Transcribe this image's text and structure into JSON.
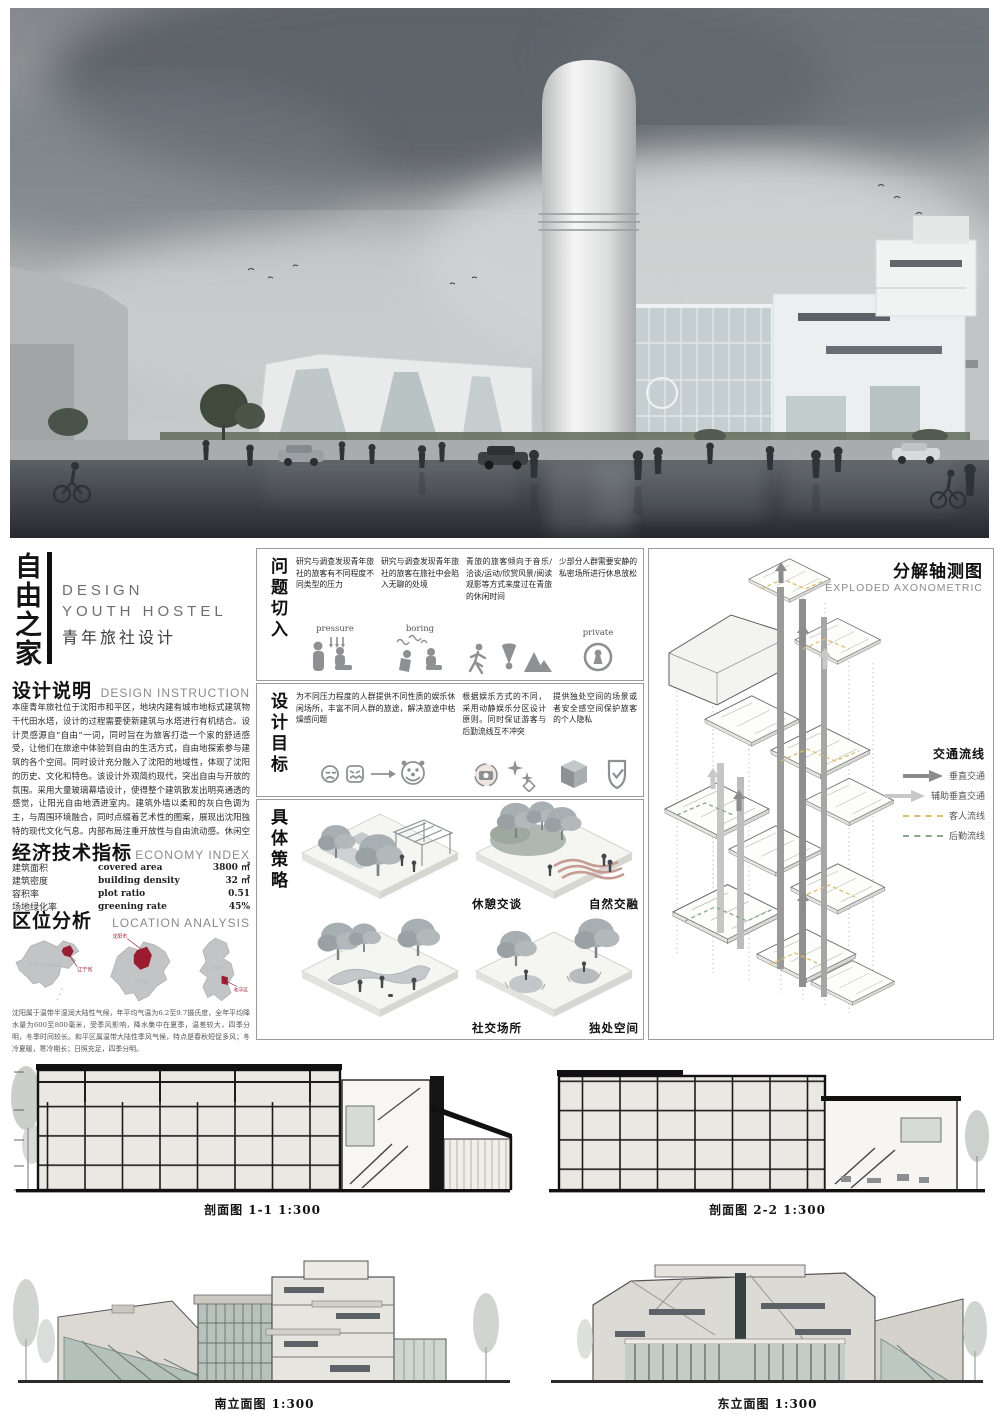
{
  "title_block": {
    "main_title": "自由之家",
    "line_en1": "DESIGN",
    "line_en2": "YOUTH HOSTEL",
    "line_cn": "青年旅社设计"
  },
  "design_instruction": {
    "heading_cn": "设计说明",
    "heading_en": "DESIGN INSTRUCTION",
    "body": "本座青年旅社位于沈阳市和平区，地块内建有城市地标式建筑物千代田水塔，设计的过程需要使新建筑与水塔进行有机结合。设计灵感源自“自由”一词，同时旨在为旅客打造一个家的舒适感受，让他们在旅途中体验到自由的生活方式，自由地探索参与建筑的各个空间。同时设计充分融入了沈阳的地域性，体现了沈阳的历史、文化和特色。该设计外观简约现代，突出自由与开放的氛围。采用大量玻璃幕墙设计，使得整个建筑散发出明亮通透的感觉，让阳光自由地洒进室内。建筑外墙以柔和的灰白色调为主，与周围环境融合，同时点缀着艺术性的图案，展现出沈阳独特的现代文化气息。内部布局注重开放性与自由流动感。休闲空间采用开阔的设计，营造出自由自在的氛围。建筑根据功能自然分为餐饮后勤、休闲娱乐、住宿三大部分，并通过打破各层空间关系、视线和空间保持联通等手法在建筑中体现“自由”的主题。自家青年旅社致力于打造一个温馨舒适、自由自在的旅居空间，让每一位旅客都能在这里找到家的感觉。"
  },
  "economy_index": {
    "heading_cn": "经济技术指标",
    "heading_en": "ECONOMY INDEX",
    "rows": [
      {
        "label_cn": "建筑面积",
        "label_en": "covered area",
        "value": "3800 ㎡"
      },
      {
        "label_cn": "建筑密度",
        "label_en": "building density",
        "value": "32 ㎡"
      },
      {
        "label_cn": "容积率",
        "label_en": "plot ratio",
        "value": "0.51"
      },
      {
        "label_cn": "场地绿化率",
        "label_en": "greening rate",
        "value": "45%"
      }
    ]
  },
  "location_analysis": {
    "heading_cn": "区位分析",
    "heading_en": "LOCATION ANALYSIS",
    "maps": [
      {
        "name": "china-map",
        "highlight_label": "辽宁省",
        "faint_label": "中华人民共和国"
      },
      {
        "name": "liaoning-map",
        "highlight_label": "沈阳市",
        "faint_label": "辽宁省"
      },
      {
        "name": "shenyang-map",
        "highlight_label": "和平区",
        "faint_label": "沈阳市"
      }
    ],
    "note": "沈阳属于温带半湿润大陆性气候，年平均气温为6.2至9.7摄氏度，全年平均降水量为600至800毫米，受季风影响，降水集中在夏季，温差较大，四季分明，冬季时间较长。和平区属温带大陆性季风气候，特点是春秋短促多风；冬冷夏暖，寒冷期长；日照充足，四季分明。"
  },
  "problems": {
    "title": "问题切入",
    "items": [
      {
        "text": "研究与调查发现青年旅社的旅客有不同程度不同类型的压力",
        "icon_word": "pressure",
        "icon": "pressure-massage-icon"
      },
      {
        "text": "研究与调查发现青年旅社的旅客在旅社中会陷入无聊的处境",
        "icon_word": "boring",
        "icon": "boring-sitting-icon"
      },
      {
        "text": "青旅的旅客倾向于音乐/洽谈/运动/欣赏风景/阅读观影等方式来度过在青旅的休闲时间",
        "icon_word": "",
        "icon": "running-badminton-mountain-icons"
      },
      {
        "text": "少部分人群需要安静的私密场所进行休息放松",
        "icon_word": "private",
        "icon": "keyhole-icon"
      }
    ]
  },
  "goals": {
    "title": "设计目标",
    "items": [
      {
        "text": "为不同压力程度的人群提供不同性质的娱乐休闲场所，丰富不同人群的旅途，解决旅途中枯燥感问题",
        "icon": "sad-to-happy-faces-icon"
      },
      {
        "text": "根据娱乐方式的不同，采用动静娱乐分区设计原则。同时保证游客与后勤流线互不冲突",
        "icon": "camera-sparkle-icon"
      },
      {
        "text": "提供独处空间的场景或者安全感空间保护旅客的个人隐私",
        "icon": "cube-shield-icon"
      }
    ]
  },
  "strategies": {
    "title": "具体策略",
    "items": [
      {
        "caption": "休憩交谈"
      },
      {
        "caption": "自然交融"
      },
      {
        "caption": "社交场所"
      },
      {
        "caption": "独处空间"
      }
    ]
  },
  "axonometric": {
    "heading_cn": "分解轴测图",
    "heading_en": "EXPLODED AXONOMETRIC",
    "legend_title": "交通流线",
    "legend": [
      {
        "label": "垂直交通",
        "style": "arrow",
        "color": "#8c8c8c"
      },
      {
        "label": "辅助垂直交通",
        "style": "arrow",
        "color": "#c8c8c8"
      },
      {
        "label": "客人流线",
        "style": "dashed",
        "color": "#ddbe6a"
      },
      {
        "label": "后勤流线",
        "style": "dashed",
        "color": "#85ab88"
      }
    ]
  },
  "drawings": {
    "section11_caption": "剖面图 1-1 1:300",
    "section22_caption": "剖面图 2-2 1:300",
    "south_caption": "南立面图 1:300",
    "east_caption": "东立面图 1:300"
  },
  "colors": {
    "map_highlight_red": "#9b1b30",
    "guest_flow_yellow": "#ddbe6a",
    "service_flow_green": "#85ab88",
    "vertical_traffic_gray": "#8c8c8c",
    "aux_vertical_traffic_gray": "#c8c8c8"
  }
}
